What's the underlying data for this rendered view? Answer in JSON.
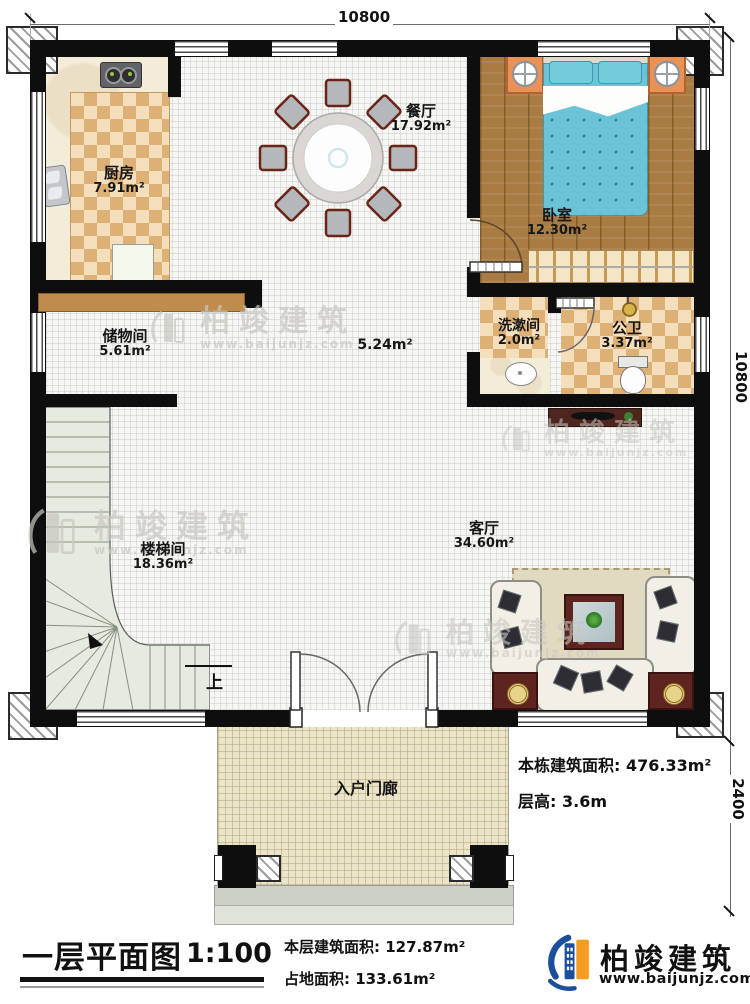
{
  "dims": {
    "top": "10800",
    "right_upper": "10800",
    "right_lower": "2400"
  },
  "rooms": [
    {
      "id": "kitchen",
      "name": "厨房",
      "area": "7.91m²"
    },
    {
      "id": "dining",
      "name": "餐厅",
      "area": "17.92m²"
    },
    {
      "id": "bedroom",
      "name": "卧室",
      "area": "12.30m²"
    },
    {
      "id": "washroom",
      "name": "洗漱间",
      "area": "2.0m²"
    },
    {
      "id": "toilet",
      "name": "公卫",
      "area": "3.37m²"
    },
    {
      "id": "storage",
      "name": "储物间",
      "area": "5.61m²"
    },
    {
      "id": "stairwell",
      "name": "楼梯间",
      "area": "18.36m²"
    },
    {
      "id": "living",
      "name": "客厅",
      "area": "34.60m²"
    },
    {
      "id": "porch",
      "name": "入户门廊",
      "area": ""
    },
    {
      "id": "corridor",
      "name": "",
      "area": "5.24m²"
    }
  ],
  "stairs": {
    "up_label": "上"
  },
  "notes": {
    "building_area_label": "本栋建筑面积:",
    "building_area": "476.33m²",
    "floor_height_label": "层高:",
    "floor_height": "3.6m"
  },
  "title_block": {
    "title": "一层平面图",
    "scale": "1:100",
    "floor_area_label": "本层建筑面积:",
    "floor_area": "127.87m²",
    "land_area_label": "占地面积:",
    "land_area": "133.61m²"
  },
  "brand": {
    "name": "柏竣建筑",
    "url": "www.baijunjz.com"
  },
  "watermark": {
    "name": "柏竣建筑",
    "url": "www.baijunjz.com"
  }
}
